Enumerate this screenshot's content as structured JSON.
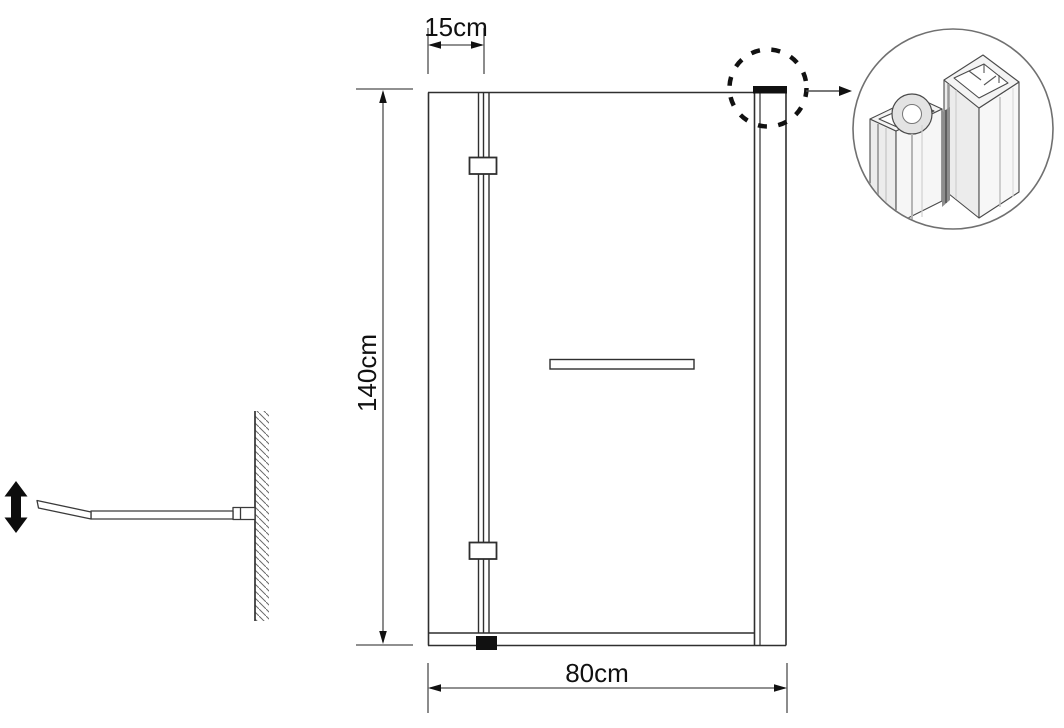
{
  "drawing": {
    "type": "technical-line-drawing",
    "dimensions": {
      "top_width": "15cm",
      "height": "140cm",
      "bottom_width": "80cm"
    },
    "colors": {
      "line": "#2f2f2f",
      "dimension_line": "#4d4d4d",
      "arrow": "#111111",
      "text": "#111111",
      "background": "#ffffff",
      "detail_face_light": "#f6f6f6",
      "detail_face_shade": "#ececec",
      "detail_seam": "#8d8d8d",
      "pivot_block": "#111111"
    },
    "icons": {
      "vertical_adjust_arrow": "double-headed-vertical-arrow",
      "detail_callout": "dashed-circle-with-arrow",
      "detail_view": "profile-cross-section-isometric"
    }
  }
}
